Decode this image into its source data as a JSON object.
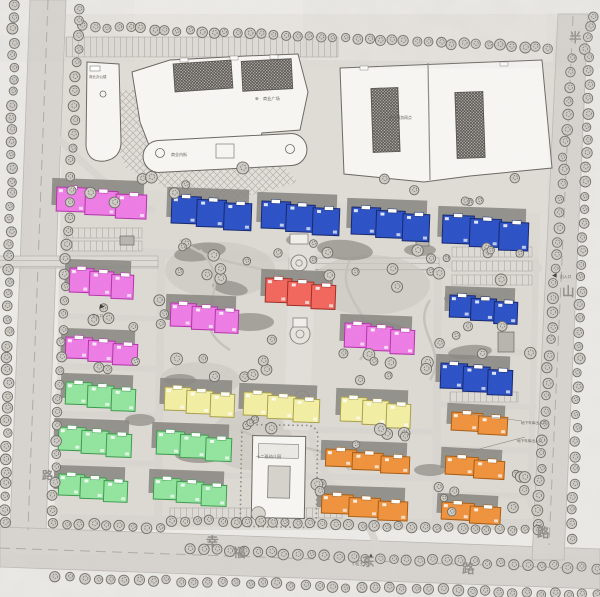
{
  "plan": {
    "road_names": {
      "bottom": {
        "name": "幸福东路",
        "chars": [
          {
            "ch": "幸",
            "x": 206,
            "y": 546
          },
          {
            "ch": "福",
            "x": 233,
            "y": 557
          },
          {
            "ch": "东",
            "x": 362,
            "y": 566
          },
          {
            "ch": "路",
            "x": 462,
            "y": 573
          }
        ]
      },
      "right": {
        "name": "半山路",
        "chars": [
          {
            "ch": "半",
            "x": 569,
            "y": 42
          },
          {
            "ch": "山",
            "x": 562,
            "y": 296
          },
          {
            "ch": "路",
            "x": 537,
            "y": 537
          }
        ]
      },
      "left": {
        "name": "路",
        "chars": [
          {
            "ch": "路",
            "x": 42,
            "y": 479
          }
        ]
      }
    },
    "facilities": [
      {
        "id": "office",
        "label": "商业办公楼",
        "x": 89,
        "y": 78,
        "size": 3.5
      },
      {
        "id": "mall",
        "label": "商业广场",
        "x": 263,
        "y": 100,
        "size": 4.2,
        "prefix": "⊕",
        "px": 255,
        "py": 100
      },
      {
        "id": "rightmall",
        "label": "商业服务网点",
        "x": 389,
        "y": 119,
        "size": 3.8
      },
      {
        "id": "annex",
        "label": "商业内街",
        "x": 171,
        "y": 156,
        "size": 4.0
      },
      {
        "id": "kindergarten",
        "label": "十二班幼儿园",
        "x": 256,
        "y": 458,
        "size": 4.2
      }
    ],
    "entrances": [
      {
        "symbol": "▶",
        "x": 100,
        "y": 308,
        "label": "主入口",
        "lx": 92,
        "ly": 317
      },
      {
        "symbol": "◀",
        "x": 552,
        "y": 277,
        "label": "出入口",
        "lx": 560,
        "ly": 278
      },
      {
        "symbol": "▲",
        "x": 368,
        "y": 557,
        "label": "小区主入口",
        "lx": 352,
        "ly": 565
      }
    ],
    "annotations": [
      {
        "text": "地下车库出入口",
        "x": 521,
        "y": 424,
        "size": 3.6
      },
      {
        "text": "地下车库出入口",
        "x": 517,
        "y": 442,
        "size": 3.6
      }
    ],
    "buildings": [
      [
        "pink",
        57,
        187,
        92,
        27,
        3,
        2
      ],
      [
        "pink",
        70,
        268,
        66,
        27,
        3,
        2
      ],
      [
        "pink",
        171,
        303,
        70,
        26,
        3,
        2
      ],
      [
        "pink",
        345,
        323,
        72,
        27,
        3,
        2
      ],
      [
        "pink",
        66,
        337,
        74,
        24,
        3,
        2
      ],
      [
        "red",
        266,
        278,
        72,
        27,
        3,
        2
      ],
      [
        "blue",
        172,
        196,
        82,
        30,
        3,
        2
      ],
      [
        "blue",
        262,
        201,
        80,
        30,
        3,
        2
      ],
      [
        "blue",
        352,
        207,
        80,
        30,
        3,
        2
      ],
      [
        "blue",
        443,
        215,
        88,
        31,
        3,
        2
      ],
      [
        "blue",
        450,
        295,
        70,
        25,
        3,
        2
      ],
      [
        "blue",
        441,
        363,
        74,
        28,
        3,
        2
      ],
      [
        "green",
        66,
        382,
        72,
        25,
        3,
        2
      ],
      [
        "green",
        59,
        427,
        75,
        26,
        3,
        2
      ],
      [
        "green",
        59,
        474,
        71,
        24,
        3,
        2
      ],
      [
        "green",
        157,
        431,
        77,
        26,
        3,
        2
      ],
      [
        "green",
        154,
        478,
        75,
        24,
        3,
        2
      ],
      [
        "yellow",
        165,
        387,
        72,
        26,
        3,
        2
      ],
      [
        "yellow",
        244,
        392,
        78,
        26,
        3,
        2
      ],
      [
        "yellow",
        341,
        397,
        72,
        27,
        3,
        2
      ],
      [
        "orange",
        452,
        412,
        58,
        21,
        2,
        3
      ],
      [
        "orange",
        326,
        449,
        86,
        20,
        3,
        2
      ],
      [
        "orange",
        446,
        456,
        61,
        21,
        2,
        3
      ],
      [
        "orange",
        322,
        494,
        88,
        22,
        3,
        2
      ],
      [
        "orange",
        442,
        502,
        61,
        20,
        2,
        3
      ]
    ],
    "colors": {
      "pink": {
        "fill": "#ee7ce6",
        "stroke": "#b233a8"
      },
      "blue": {
        "fill": "#2b51c7",
        "stroke": "#14266e"
      },
      "red": {
        "fill": "#f2665c",
        "stroke": "#9e2d26"
      },
      "green": {
        "fill": "#92e59e",
        "stroke": "#3f9a50"
      },
      "yellow": {
        "fill": "#f3efa3",
        "stroke": "#aaa04e"
      },
      "orange": {
        "fill": "#f0923c",
        "stroke": "#a85c12"
      },
      "shadow": "#8b8883",
      "road": "#d8d5d0",
      "ground": "#e0ddd7",
      "paper": "#ecebe7",
      "tree_fill": "#cfccc6",
      "tree_stroke": "#6f6d68",
      "white_building": "#f8f7f4",
      "outline": "#6b6862",
      "label": "#5f5d59",
      "road_label": "#8f8d89"
    }
  }
}
